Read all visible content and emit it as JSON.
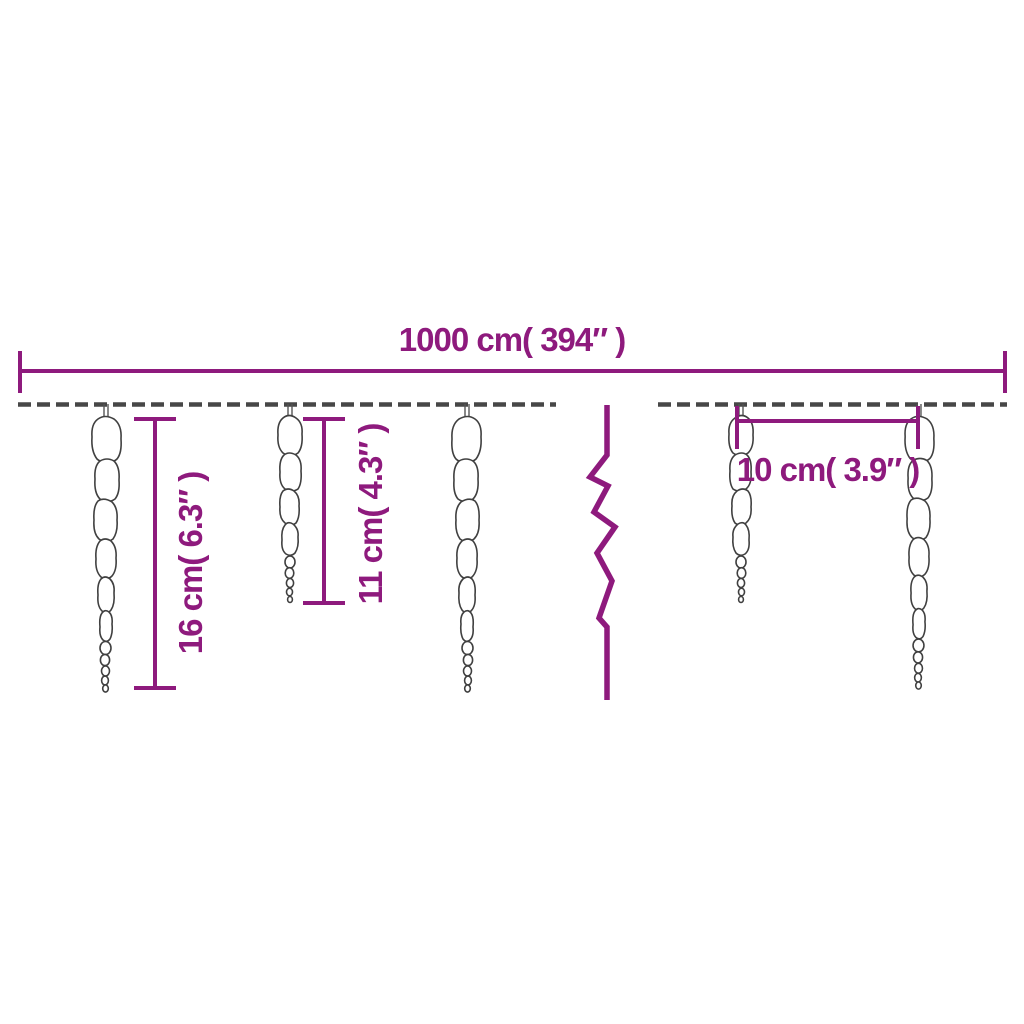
{
  "product_diagram": {
    "description_labels": {
      "total_length": {
        "label": "1000 cm( 394″ )",
        "cm": 1000,
        "inches": 394
      },
      "long_icicle_height": {
        "label": "16 cm( 6.3″ )",
        "cm": 16,
        "inches": 6.3
      },
      "short_icicle_height": {
        "label": "11 cm( 4.3″ )",
        "cm": 11,
        "inches": 4.3
      },
      "icicle_spacing": {
        "label": "10 cm( 3.9″ )",
        "cm": 10,
        "inches": 3.9
      }
    },
    "colors": {
      "dimension_line": "#8e1a7d",
      "wire": "#474747",
      "icicle_outline": "#404040",
      "background": "#ffffff"
    },
    "icicle_count_shown": 5
  }
}
